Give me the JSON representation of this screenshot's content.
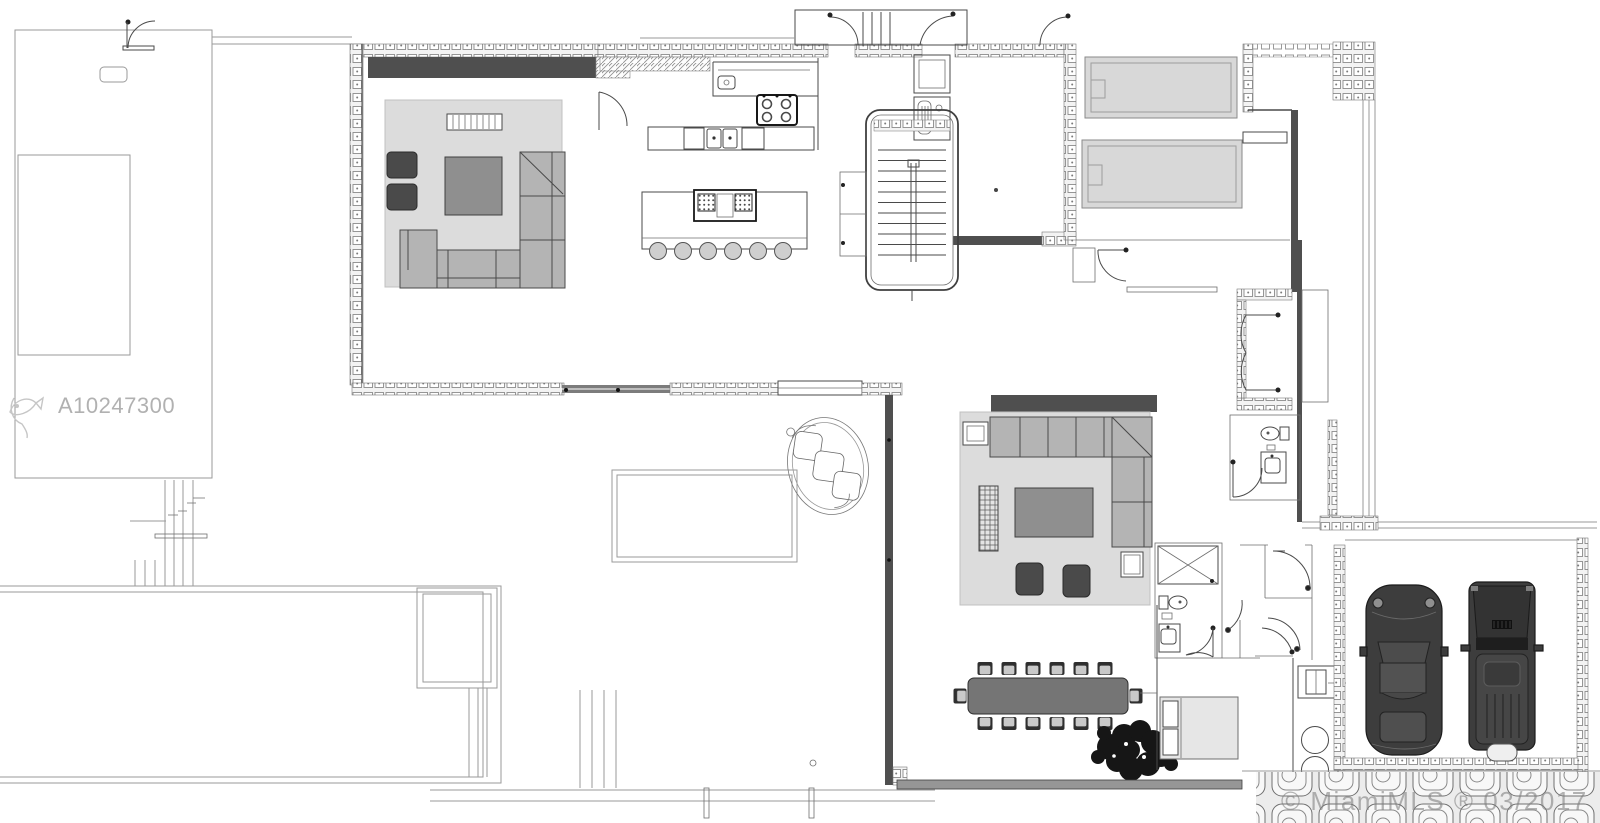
{
  "watermarks": {
    "listing_id": "A10247300",
    "copyright": "© MiamiMLS ® 03/2017"
  },
  "colors": {
    "line": "#4a4a4a",
    "line_light": "#9a9a9a",
    "wall_dark": "#4f4f4f",
    "rug": "#dcdcdc",
    "sofa": "#b4b4b4",
    "coffee_table": "#8f8f8f",
    "dining_table": "#757575",
    "dark_furniture": "#4a4a4a",
    "bed": "#d8d8d8",
    "car": "#3d3d3d",
    "tree": "#161616",
    "watermark": "#b1b1b1"
  },
  "legend": {
    "elements": [
      "living-room-sectional",
      "armchair",
      "coffee-table",
      "media-console",
      "kitchen-counter",
      "cooktop",
      "kitchen-sink",
      "kitchen-island",
      "bar-stool",
      "staircase",
      "entry-doors",
      "bed",
      "nightstand",
      "hall-double-doors",
      "toilet",
      "sink-vanity",
      "shower",
      "family-room-sectional",
      "ottoman",
      "side-table",
      "dining-table",
      "dining-chair",
      "tree-planter",
      "spiral-lounge-chair",
      "washer",
      "dryer",
      "sports-car",
      "suv-car",
      "garage",
      "paver-walkway",
      "pool-terrace",
      "outdoor-structure"
    ]
  }
}
